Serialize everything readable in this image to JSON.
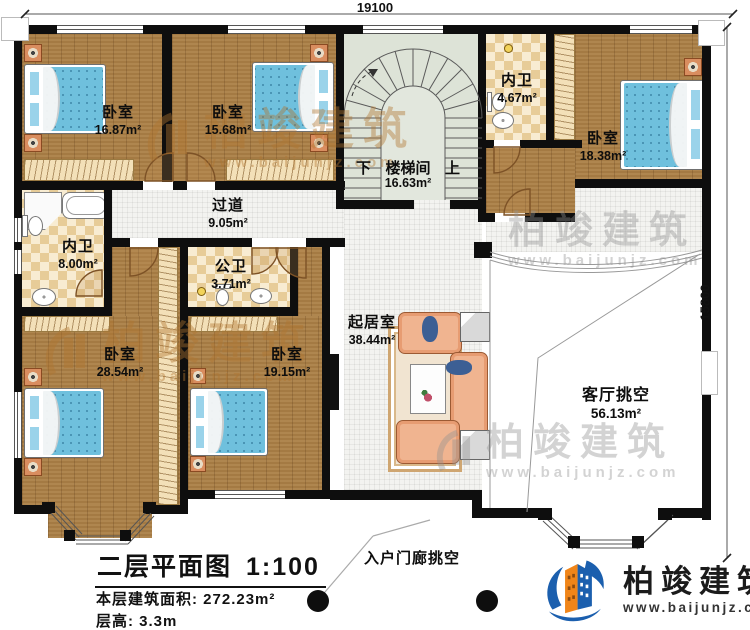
{
  "symbols": [
    "bed",
    "nightstand",
    "wardrobe",
    "toilet",
    "sink",
    "bathtub",
    "shower",
    "sofa",
    "coffee-table",
    "end-table",
    "tv",
    "carpet",
    "stairs",
    "door",
    "window",
    "column",
    "lamp"
  ],
  "dimensions": {
    "top": "19100",
    "right": "15800"
  },
  "rooms": {
    "bedroom_tl": {
      "name": "卧室",
      "area": "16.87m²"
    },
    "bedroom_tm": {
      "name": "卧室",
      "area": "15.68m²"
    },
    "stairwell": {
      "name": "楼梯间",
      "area": "16.63m²",
      "down": "下",
      "up": "上"
    },
    "bath_tr": {
      "name": "内卫",
      "area": "4.67m²"
    },
    "bedroom_r": {
      "name": "卧室",
      "area": "18.38m²"
    },
    "bath_l": {
      "name": "内卫",
      "area": "8.00m²"
    },
    "corridor": {
      "name": "过道",
      "area": "9.05m²"
    },
    "bath_m": {
      "name": "公卫",
      "area": "3.71m²"
    },
    "bedroom_bl": {
      "name": "卧室",
      "area": "28.54m²"
    },
    "bedroom_bm": {
      "name": "卧室",
      "area": "19.15m²"
    },
    "living": {
      "name": "起居室",
      "area": "38.44m²"
    },
    "living_void": {
      "name": "客厅挑空",
      "area": "56.13m²"
    },
    "porch_void": {
      "name": "入户门廊挑空"
    }
  },
  "title_block": {
    "title": "二层平面图",
    "scale": "1:100",
    "floor_area_label": "本层建筑面积:",
    "floor_area_value": "272.23m²",
    "floor_height_label": "层高:",
    "floor_height_value": "3.3m"
  },
  "brand": {
    "name": "柏竣建筑",
    "website": "www.baijunjz.com"
  },
  "watermark": {
    "name": "柏竣建筑",
    "website": "www.baijunjz.com"
  },
  "colors": {
    "wall": "#0e0e0e",
    "wood_floor": "#ab7f46",
    "bed_blue": "#6fc0dd",
    "tile": "#f3f3f0",
    "stair_room": "#dde3d7",
    "bath_checker": "#e7cc98",
    "closet": "#f3e0b8",
    "sofa": "#f0b490",
    "brand_blue": "#1b5fae",
    "brand_orange": "#f08519"
  }
}
